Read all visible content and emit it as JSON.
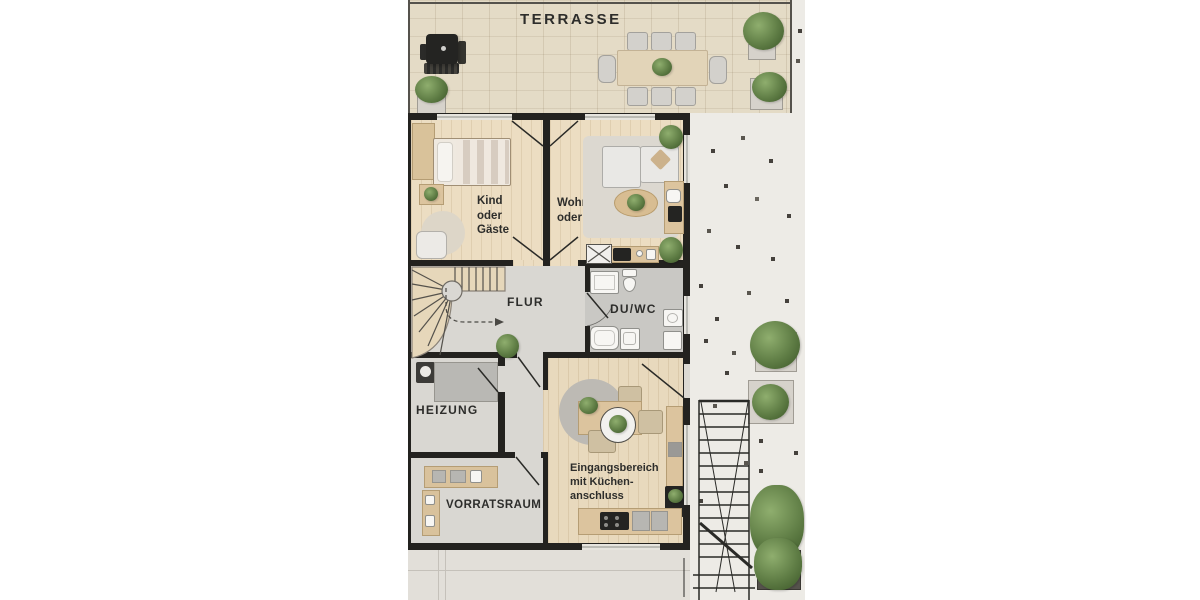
{
  "scene": {
    "kind": "architectural floor plan, top-down 3D render",
    "floor_shown": "ground floor with terrace, gravel side yard and exterior cellar stair"
  },
  "labels": {
    "terrace": "TERRASSE",
    "child_room": [
      "Kind",
      "oder",
      "Gäste"
    ],
    "living_room": [
      "Wohnen",
      "oder Büro"
    ],
    "hallway": "FLUR",
    "shower_wc": "DU/WC",
    "heating": "HEIZUNG",
    "storage": "VORRATSRAUM",
    "entrance": [
      "Eingangsbereich",
      "mit Küchen-",
      "anschluss"
    ]
  },
  "colors": {
    "background": "#ffffff",
    "wall": "#23221f",
    "terrace_wood": "#e4dbc6",
    "room_wood": "#ecddc2",
    "entrance_wood": "#e8d9bd",
    "concrete": "#d9d7d2",
    "bathroom_tile": "#c9c8c4",
    "gravel": "#edebe6",
    "pavement": "#e2dfd9",
    "plant_green": "#5f7d45",
    "label_text": "#2d2d2b"
  },
  "icons": [
    "grill-icon",
    "dining-table-icon",
    "chair-icon",
    "planter-icon",
    "plant-icon",
    "bed-icon",
    "wardrobe-icon",
    "nightstand-icon",
    "armchair-icon",
    "rug-icon",
    "sofa-icon",
    "coffee-table-icon",
    "desk-icon",
    "tv-console-icon",
    "side-table-icon",
    "washing-machine-icon",
    "stairs-icon",
    "shower-icon",
    "toilet-icon",
    "sink-icon",
    "bathtub-icon",
    "boiler-icon",
    "heating-unit-icon",
    "storage-shelf-icon",
    "dining-set-icon",
    "kitchen-counter-icon",
    "cooktop-icon",
    "tall-cabinet-icon",
    "exterior-stairs-icon",
    "door-swing-icon"
  ]
}
